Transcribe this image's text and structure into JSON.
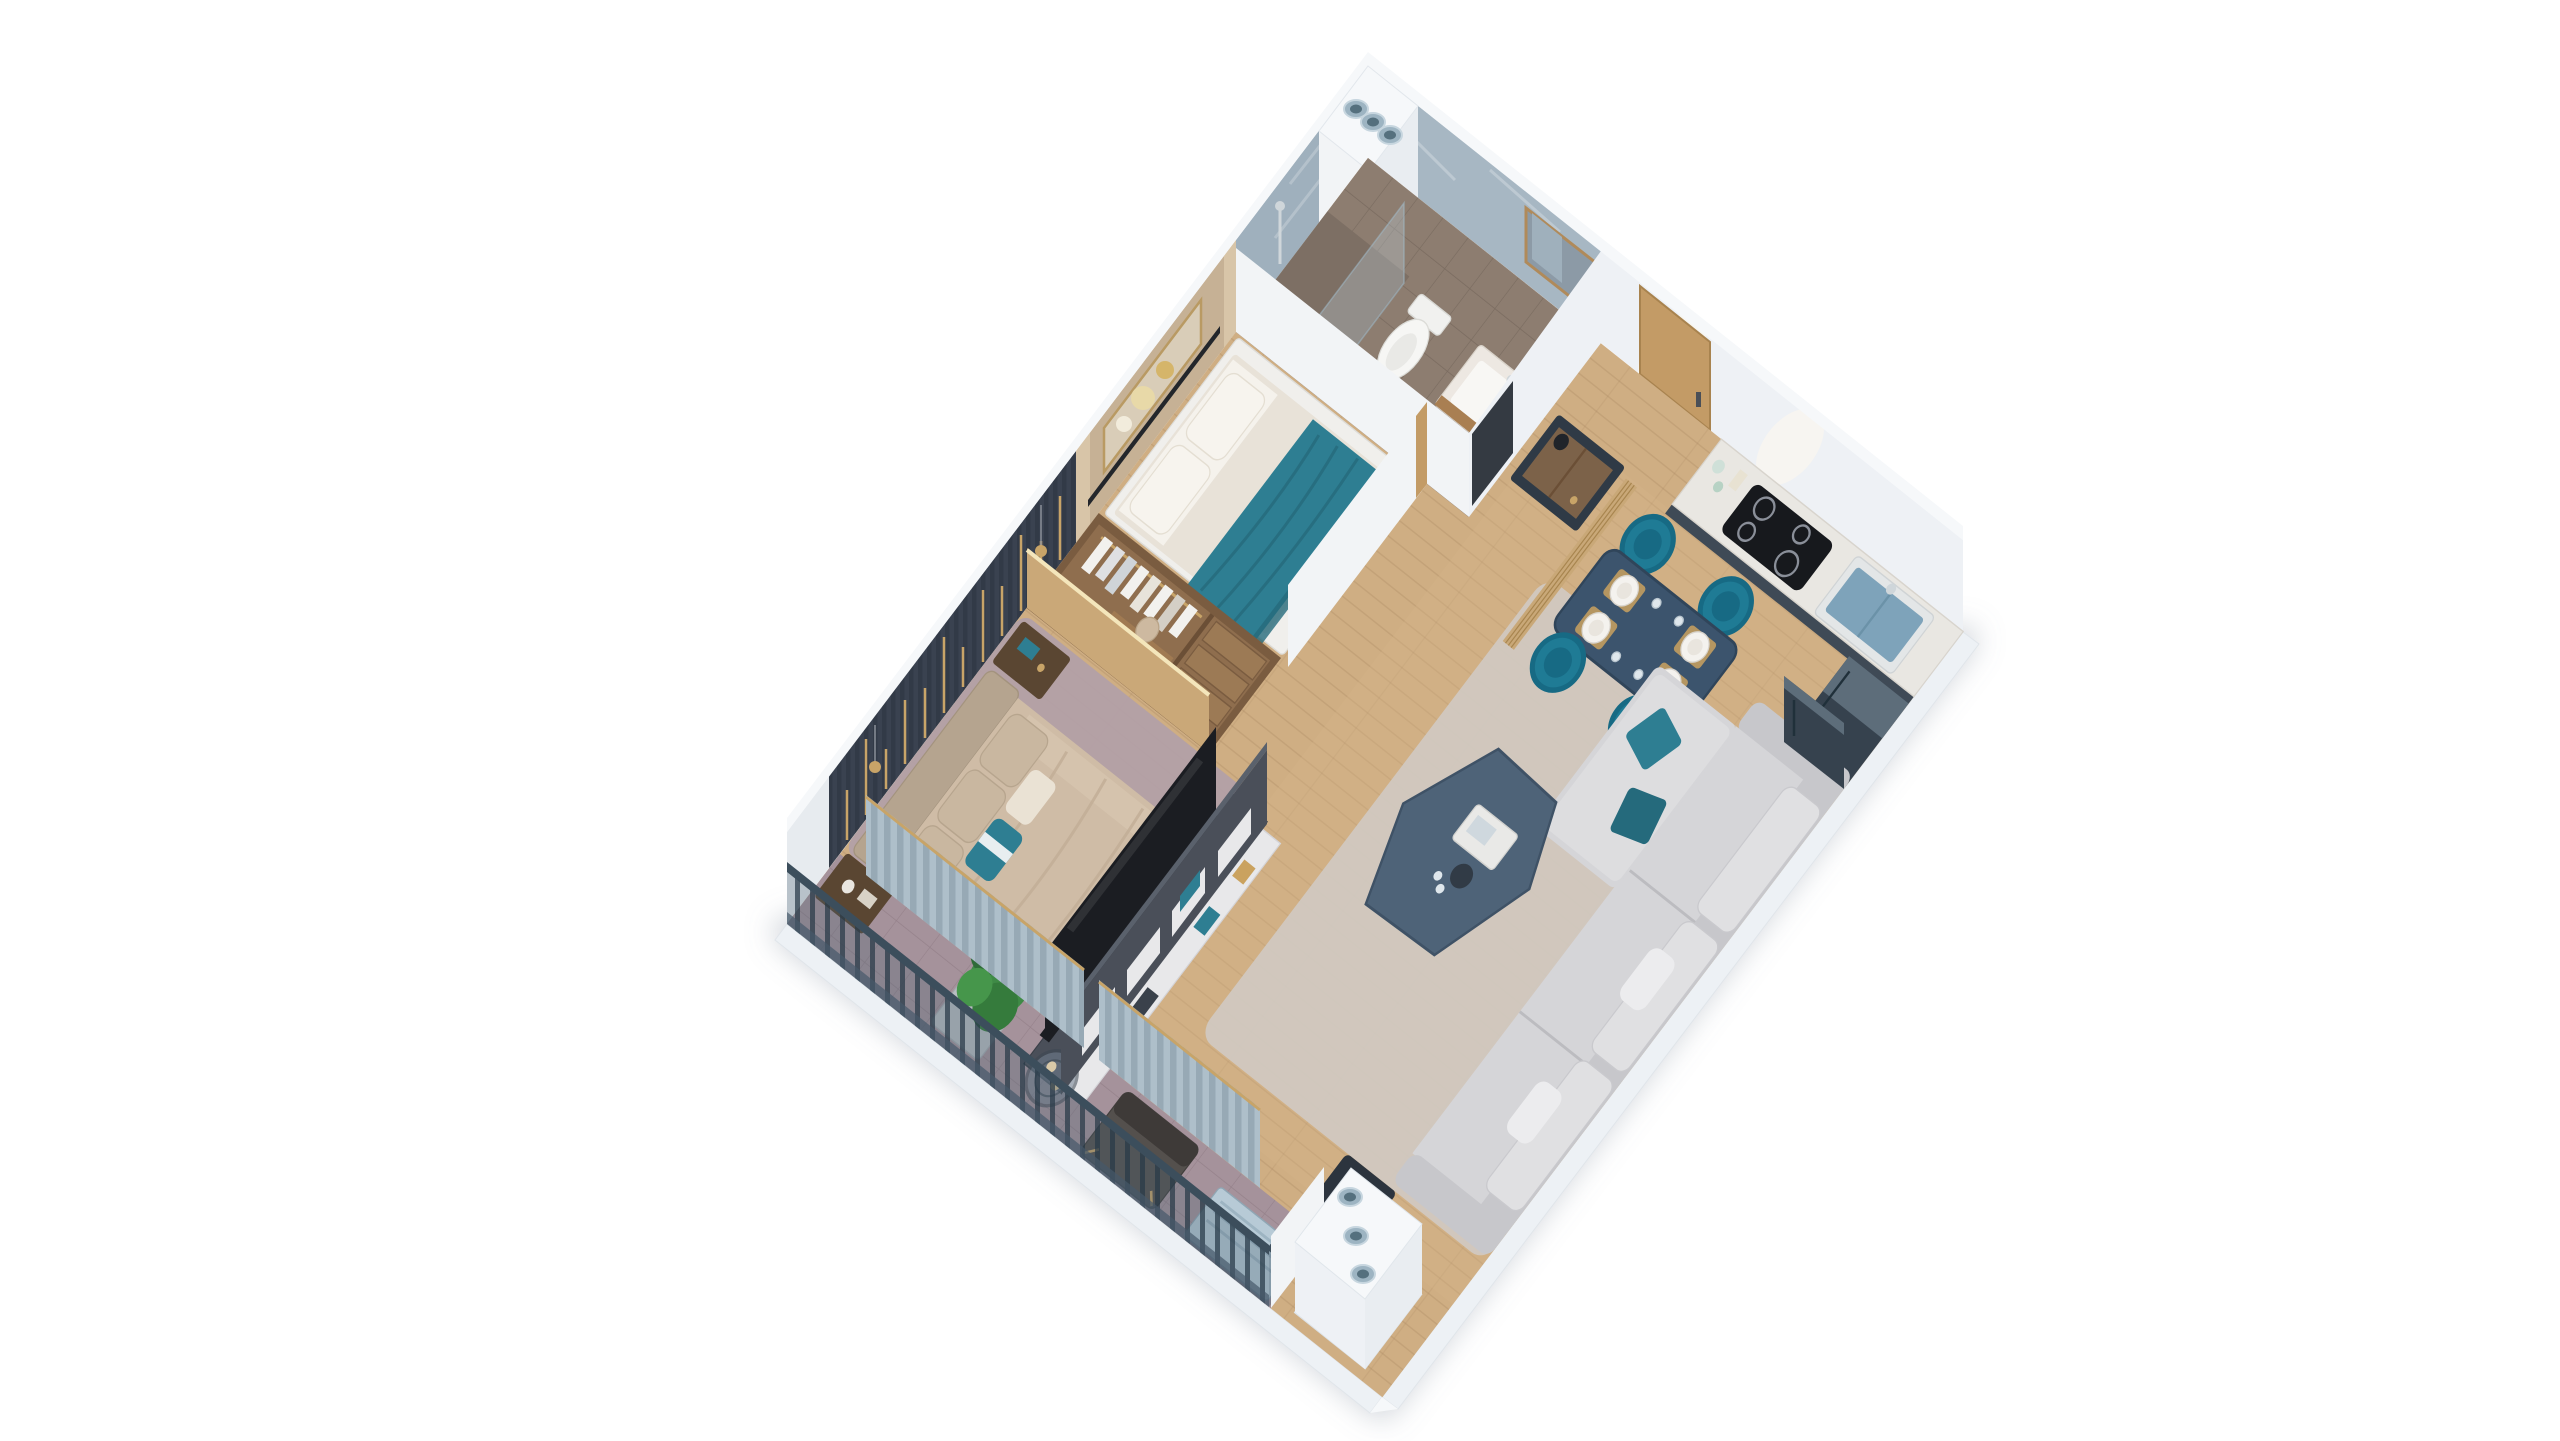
{
  "meta": {
    "title": "3D isometric apartment floor plan render",
    "view": "axonometric cutaway, furnished one-bedroom apartment, no visible text"
  },
  "colors": {
    "bg": "#ffffff",
    "plinth": "#edf1f5",
    "wallWhite": "#eef1f5",
    "wallWhite2": "#f2f4f6",
    "wallTop": "#f6f8fa",
    "wallPanel": "#e9edf1",
    "marble": "#a7b7c3",
    "marbleDark": "#9fb0bd",
    "beige": "#c6b195",
    "beigeLight": "#d8c5a8",
    "slat": "#3a4250",
    "gold": "#c8a468",
    "woodFloor": "#cfae83",
    "woodTint": "#d6b78c",
    "bathFloor": "#8d7d70",
    "showerFloor": "#7d6f64",
    "balconyFloor": "#a5929b",
    "rugMauve": "#b2a0a8",
    "rugLiving": "#d0cac3",
    "doorOak": "#c39b66",
    "counter": "#e9e7e2",
    "cabinet": "#3f4a56",
    "cooktop": "#17191d",
    "sink": "#7ea3ba",
    "chrome": "#cfd6da",
    "fridge": "#36424e",
    "fridgeTop": "#5d6d7a",
    "tableNavy": "#3c546d",
    "chairTeal": "#1f7b95",
    "chairTealDark": "#176a84",
    "plate": "#f4f2ee",
    "placemat": "#caa25f",
    "screenWood": "#c9a878",
    "sideboard": "#2f3a46",
    "drawerWood": "#8a6a4a",
    "teal": "#2e7e92",
    "tealDark": "#256a7c",
    "bedWhite": "#f0efec",
    "mattress": "#e8e2d8",
    "pillow": "#f5f2ec",
    "duvet": "#cfbca6",
    "duvetShade": "#c2ae97",
    "headboard": "#b5a48f",
    "nightstand": "#5a4632",
    "wardrobe": "#7a5c40",
    "wardrobeFloor": "#8f6e4e",
    "clothes": "#f2f1ee",
    "media": "#4a4f59",
    "tv": "#1b1d22",
    "shelf": "#e8e8ea",
    "sofa": "#d5d5d8",
    "sofaShade": "#c7c7cb",
    "sofaLight": "#e0e0e2",
    "coffee": "#4e6378",
    "curtain": "#aebfca",
    "railing": "#3c4e5c",
    "plant": "#3f8a46",
    "plantDark": "#2f6b38",
    "pot": "#b9bdc2",
    "ac": "#b7cad6",
    "pipe": "#9db4c2",
    "pipeDark": "#55707e",
    "vanity": "#ede8e2",
    "woodTrim": "#a97f52",
    "glassTint": "rgba(195,215,227,0.30)",
    "shadow": "rgba(125,140,155,0.35)"
  },
  "scene": {
    "rooms": [
      {
        "name": "bathroom",
        "items": [
          "marble-walls",
          "shower-column",
          "glass-screen",
          "toilet",
          "vanity-sink",
          "mirror-cabinet",
          "tile-floor"
        ]
      },
      {
        "name": "small-bedroom",
        "items": [
          "double-bed",
          "teal-throw-blanket",
          "pillows",
          "beige-accent-wall",
          "wall-art",
          "picture-ledge-shelf"
        ]
      },
      {
        "name": "walk-in-wardrobe",
        "items": [
          "hanging-clothes",
          "open-shelves",
          "vanity-desk",
          "led-panel"
        ]
      },
      {
        "name": "master-bedroom",
        "items": [
          "king-bed",
          "upholstered-headboard",
          "teal-accent-pillow",
          "nightstand-left",
          "nightstand-right",
          "mauve-area-rug",
          "dark-slat-accent-wall",
          "gold-light-strips",
          "pendant-lamps",
          "curtains"
        ]
      },
      {
        "name": "living-room",
        "items": [
          "sectional-sofa",
          "teal-cushions",
          "organic-coffee-table",
          "area-rug",
          "media-wall",
          "tv-panel",
          "open-shelf-unit",
          "side-table-with-vase"
        ]
      },
      {
        "name": "dining-area",
        "items": [
          "navy-dining-table",
          "four-place-settings",
          "wine-glasses",
          "teal-tub-chairs",
          "wood-slat-screen",
          "sideboard-with-lamp"
        ]
      },
      {
        "name": "kitchen",
        "items": [
          "marble-countertop",
          "navy-base-cabinets",
          "induction-cooktop",
          "blue-sink",
          "chrome-faucet",
          "refrigerator",
          "counter-decor"
        ]
      },
      {
        "name": "balcony",
        "items": [
          "slate-railing",
          "potted-plant",
          "round-wire-table",
          "candles",
          "lounge-chair",
          "ac-unit",
          "tile-floor"
        ]
      },
      {
        "name": "entrance",
        "items": [
          "oak-entry-door",
          "door-handle"
        ]
      },
      {
        "name": "services",
        "items": [
          "vent-shaft-north",
          "vent-shaft-south",
          "round-pipes"
        ]
      }
    ]
  }
}
